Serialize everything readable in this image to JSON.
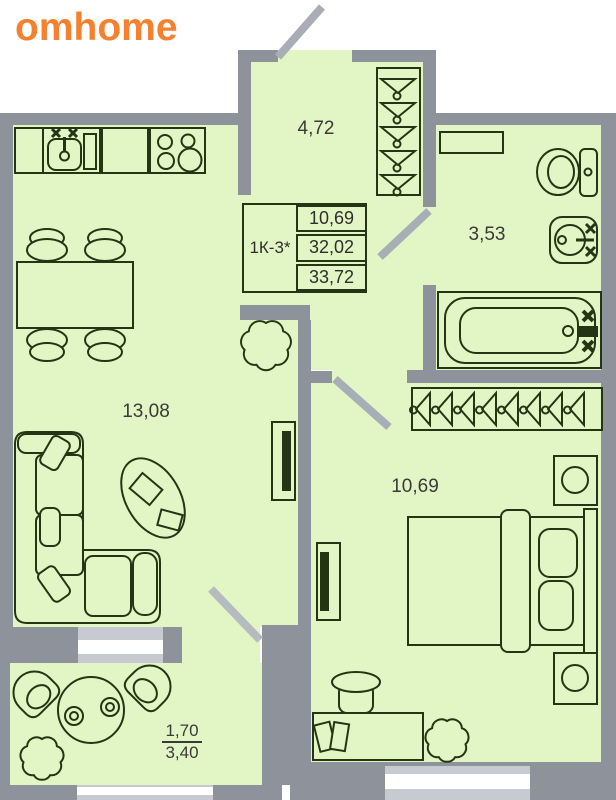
{
  "brand": {
    "name": "omhome",
    "color": "#f5812f"
  },
  "floorplan": {
    "legend": {
      "unit": "1К-3*",
      "values": [
        "10,69",
        "32,02",
        "33,72"
      ]
    },
    "rooms": [
      {
        "id": "hallway",
        "area": "4,72"
      },
      {
        "id": "bathroom",
        "area": "3,53"
      },
      {
        "id": "living-kitchen",
        "area": "13,08"
      },
      {
        "id": "bedroom",
        "area": "10,69"
      },
      {
        "id": "balcony",
        "area_coefficient": "1,70",
        "area_total": "3,40"
      }
    ],
    "colors": {
      "room_fill": "#e2f6c5",
      "wall": "#8d929b",
      "furniture_stroke": "#233512",
      "door_swing": "#a9aeb6",
      "window": "#ffffff"
    }
  }
}
